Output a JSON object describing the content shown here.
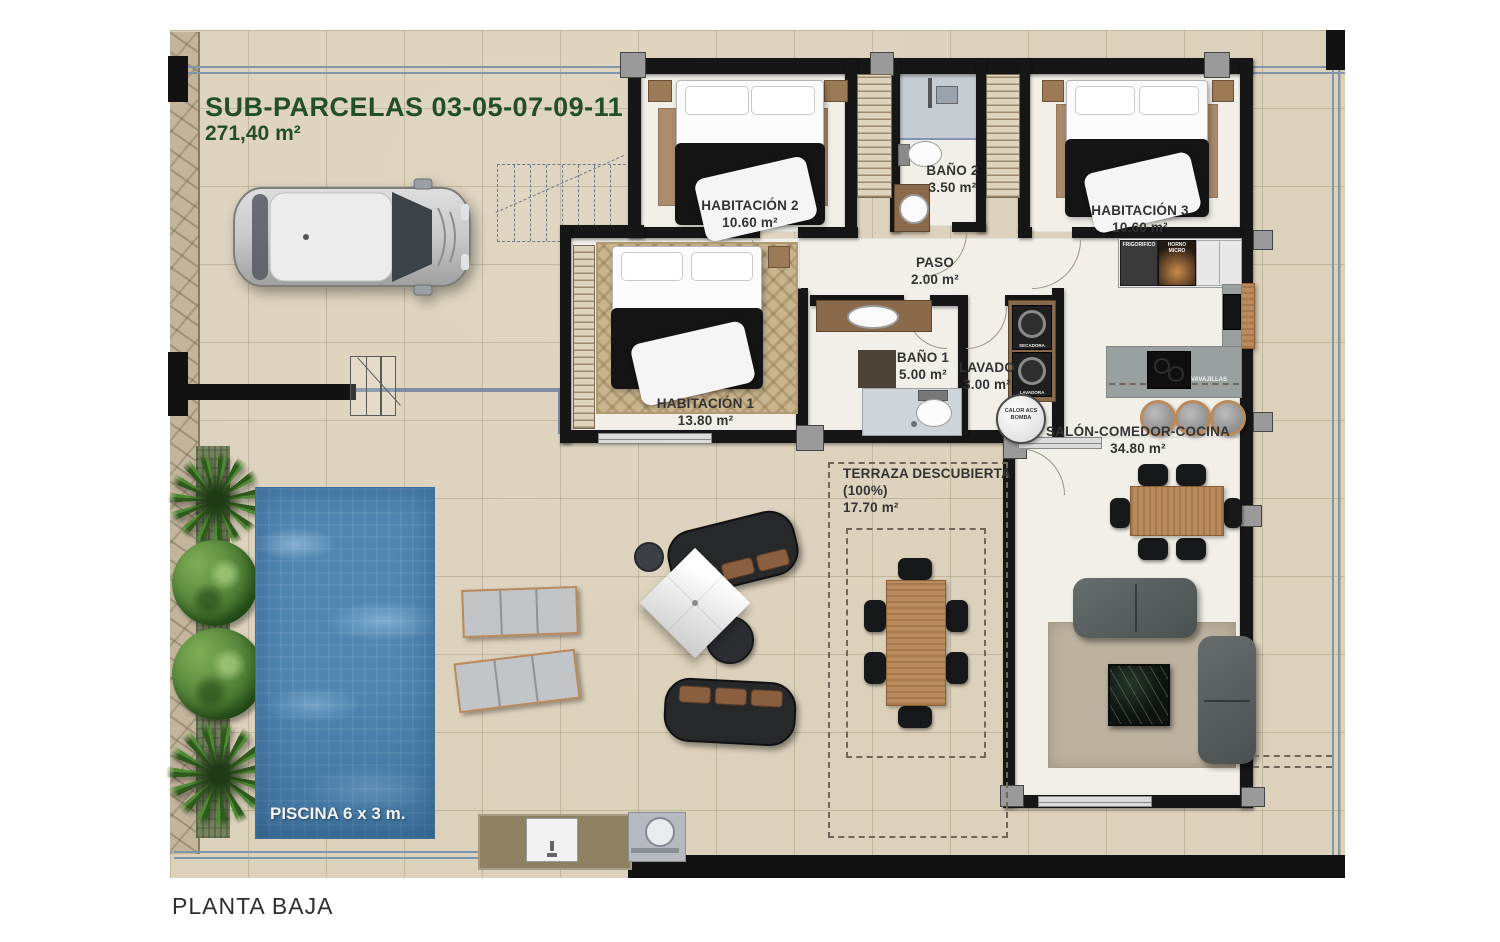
{
  "title": {
    "line1": "SUB-PARCELAS 03-05-07-09-11",
    "line2": "271,40 m²"
  },
  "footer": {
    "label": "PLANTA BAJA"
  },
  "rooms": {
    "habitacion2": {
      "name": "HABITACIÓN 2",
      "area": "10.60 m²"
    },
    "bano2": {
      "name": "BAÑO 2",
      "area": "3.50 m²"
    },
    "habitacion3": {
      "name": "HABITACIÓN 3",
      "area": "10.60 m²"
    },
    "paso": {
      "name": "PASO",
      "area": "2.00 m²"
    },
    "habitacion1": {
      "name": "HABITACIÓN 1",
      "area": "13.80 m²"
    },
    "bano1": {
      "name": "BAÑO 1",
      "area": "5.00 m²"
    },
    "lavado": {
      "name": "LAVADO",
      "area": "3.00 m²"
    },
    "salon": {
      "name": "SALÓN-COMEDOR-COCINA",
      "area": "34.80 m²"
    },
    "terraza": {
      "name": "TERRAZA DESCUBIERTA (100%)",
      "area": "17.70 m²"
    }
  },
  "pool": {
    "label": "PISCINA 6 x 3 m."
  },
  "appliances": {
    "fridge": "FRIGORIFICO",
    "oven": "HORNO MICRO",
    "dryer": "SECADORA",
    "washer": "LAVADORA",
    "dishwasher": "LAVAVAJILLAS",
    "heat_pump": "CALOR ACS BOMBA"
  },
  "colors": {
    "accent_green": "#234f28",
    "pool_blue": "#4f86b2",
    "wall_black": "#161616",
    "paving": "#dcd1bb",
    "interior_white": "#f1efe8"
  }
}
